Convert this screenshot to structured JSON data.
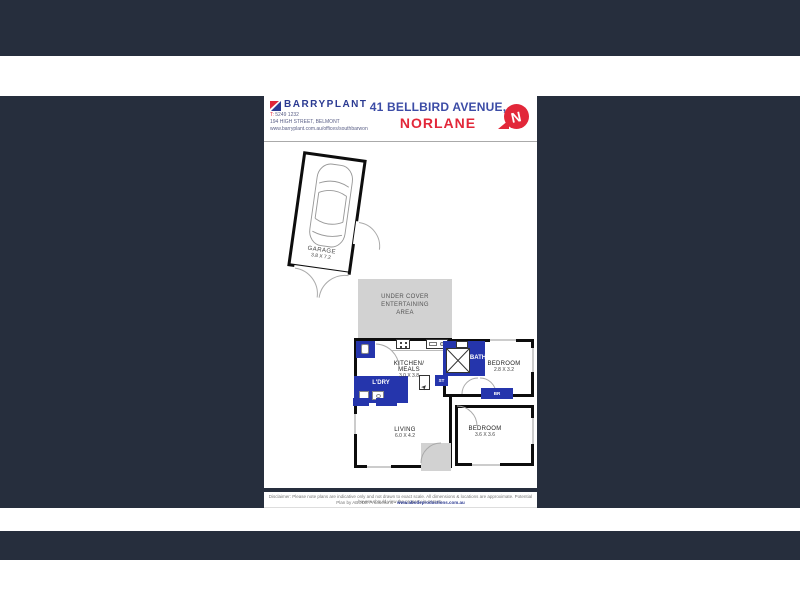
{
  "colors": {
    "background_navy": "#262e3d",
    "brand_navy": "#2b3a92",
    "title_blue": "#3c4ca6",
    "accent_red": "#e22739",
    "room_blue": "#2535ac",
    "area_gray": "#d2d2d2"
  },
  "header": {
    "brand": "BARRYPLANT",
    "phone_label": "T:",
    "phone": "5249 1232",
    "street": "194 HIGH STREET, BELMONT",
    "website": "www.barryplant.com.au/offices/southbarwon",
    "address_line1": "41 BELLBIRD AVENUE,",
    "address_line2": "NORLANE",
    "north_letter": "N"
  },
  "plan": {
    "garage": {
      "name": "GARAGE",
      "dims": "3.8 X 7.2"
    },
    "outdoor": {
      "line1": "UNDER COVER",
      "line2": "ENTERTAINING",
      "line3": "AREA"
    },
    "kitchen": {
      "line1": "KITCHEN/",
      "line2": "MEALS",
      "dims": "3.0 X 3.8"
    },
    "laundry": {
      "name": "L'DRY"
    },
    "bath": {
      "name": "BATH"
    },
    "store": {
      "name": "ST"
    },
    "bedroom1": {
      "name": "BEDROOM",
      "dims": "2.8 X 3.2"
    },
    "robe": {
      "name": "BR"
    },
    "living": {
      "name": "LIVING",
      "dims": "6.0 X 4.2"
    },
    "bedroom2": {
      "name": "BEDROOM",
      "dims": "3.6 X 3.6"
    }
  },
  "footer": {
    "disclaimer": "Disclaimer: Please note plans are indicative only and not drawn to exact scale. All dimensions & locations are approximate. Potential buyers should view the property in person.",
    "credit": "Plan by ABODE Productions - ",
    "credit_url": "www.abodeproductions.com.au"
  }
}
